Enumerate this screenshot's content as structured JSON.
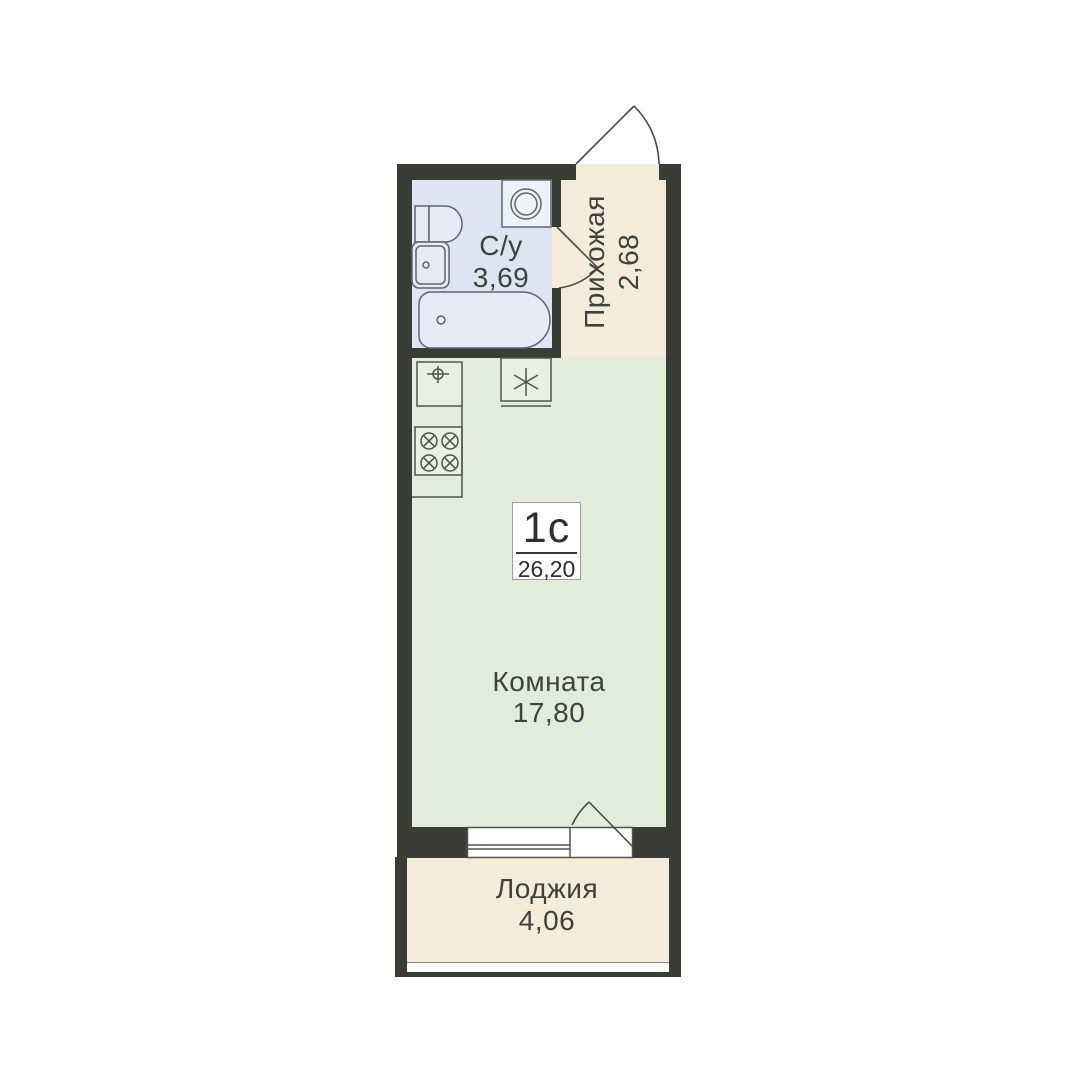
{
  "badge": {
    "type": "1с",
    "area": "26,20"
  },
  "rooms": {
    "bathroom": {
      "label": "С/у",
      "area": "3,69"
    },
    "hallway": {
      "label": "Прихожая",
      "area": "2,68"
    },
    "living": {
      "label": "Комната",
      "area": "17,80"
    },
    "loggia": {
      "label": "Лоджия",
      "area": "4,06"
    }
  },
  "colors": {
    "wall": "#3a3d35",
    "bathroom-fill": "#dde4f2",
    "hallway-fill": "#f5ebda",
    "room-fill": "#e1ecda",
    "loggia-fill": "#f5ebda",
    "fixture-stroke": "#4f554b",
    "fixture-fill": "#e8f0e2",
    "bath-fixture-stroke": "#5f6570",
    "bath-fixture-fill": "#e5eaf6",
    "door-stroke": "#474c43",
    "text": "#3d423d",
    "badge-text": "#2d3031",
    "badge-border": "#9ba09b"
  },
  "icons": {
    "bathroom": [
      "washing-machine-icon",
      "toilet-icon",
      "bathroom-sink-icon",
      "bathtub-icon"
    ],
    "kitchen": [
      "kitchen-sink-icon",
      "appliance-asterisk-icon",
      "stove-icon"
    ],
    "doors": [
      "entry-door-icon",
      "bathroom-door-icon",
      "balcony-door-icon"
    ],
    "window": [
      "window-icon"
    ]
  }
}
